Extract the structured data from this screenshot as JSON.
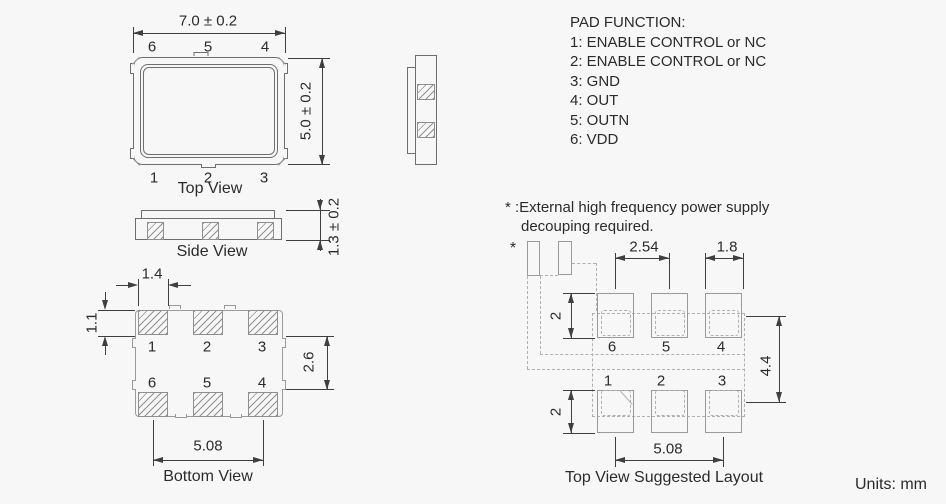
{
  "colors": {
    "background": "#f7f7f7",
    "outline": "#6e6e6e",
    "outline_light": "#9a9a9a",
    "dashed": "#b0b0b0",
    "dimension": "#3f3f3f",
    "text": "#2b2b2b"
  },
  "units_label": "Units: mm",
  "pad_function": {
    "title": "PAD FUNCTION:",
    "items": [
      "1: ENABLE CONTROL or NC",
      "2: ENABLE CONTROL or NC",
      "3: GND",
      "4: OUT",
      "5: OUTN",
      "6: VDD"
    ]
  },
  "note": {
    "line1": "* :External high frequency power supply",
    "line2": "decouping required."
  },
  "top_view": {
    "title": "Top View",
    "dim_width": "7.0 ± 0.2",
    "dim_height": "5.0 ± 0.2",
    "top_pad_labels": [
      "6",
      "5",
      "4"
    ],
    "bottom_pad_labels": [
      "1",
      "2",
      "3"
    ]
  },
  "side_view": {
    "title": "Side View",
    "dim_thickness": "1.3 ± 0.2"
  },
  "bottom_view": {
    "title": "Bottom View",
    "dim_pad_width": "1.4",
    "dim_pad_height": "1.1",
    "dim_row_gap": "2.6",
    "dim_pad_span": "5.08",
    "top_pad_labels": [
      "1",
      "2",
      "3"
    ],
    "bottom_pad_labels": [
      "6",
      "5",
      "4"
    ]
  },
  "layout_view": {
    "title": "Top View Suggested Layout",
    "asterisk": "*",
    "dim_pitch": "2.54",
    "dim_pad_width": "1.8",
    "dim_pad_height_top": "2",
    "dim_pad_height_bottom": "2",
    "dim_row_span": "4.4",
    "dim_pad_span": "5.08",
    "top_pad_labels": [
      "6",
      "5",
      "4"
    ],
    "bottom_pad_labels": [
      "1",
      "2",
      "3"
    ]
  }
}
